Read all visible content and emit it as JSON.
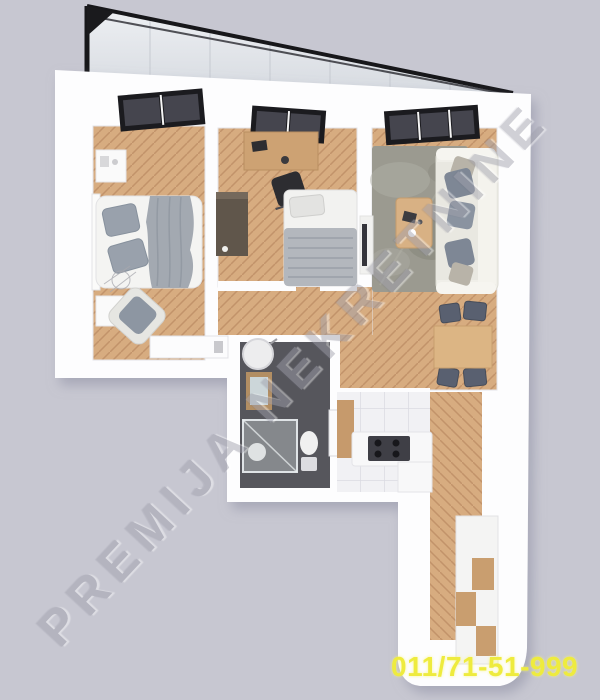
{
  "watermark": {
    "text": "PREMIJA NEKRETNINE"
  },
  "phone": {
    "number": "011/71-51-999"
  },
  "colors": {
    "background": "#c7c7d1",
    "wall": "#fdfdfe",
    "wood": "#d7ac80",
    "woodDark": "#c2936a",
    "tile": "#f1f1f4",
    "bathFloor": "#56565c",
    "rug": "#9b9a90",
    "frame": "#1b1b1f",
    "glass": "#e3e6ea",
    "accent": "#eeeb3e",
    "textile": "#8a93a0",
    "watermark": "#a0a0ac"
  }
}
